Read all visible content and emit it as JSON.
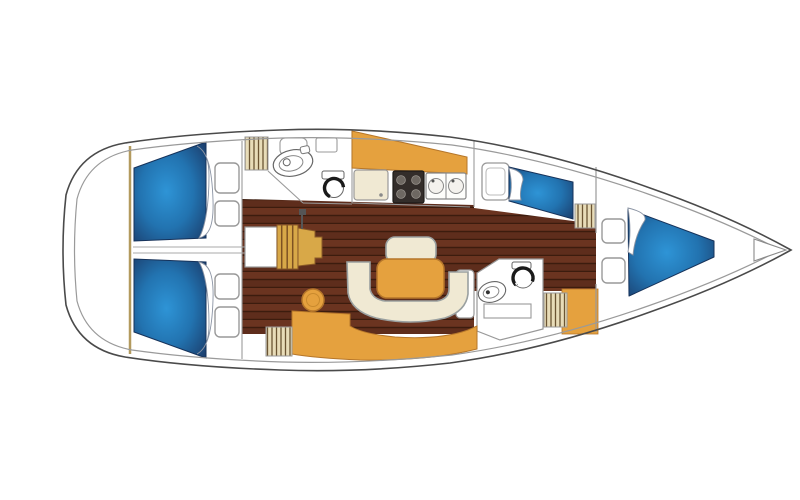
{
  "plan": {
    "diagram_type": "sailboat-interior-floorplan",
    "bow_direction": "right",
    "stern_direction": "left",
    "rooms": [
      "aft-cabin-port",
      "aft-cabin-starboard",
      "aft-head",
      "companionway",
      "saloon",
      "galley",
      "forward-cabin-port",
      "forward-head",
      "bow-cabin"
    ],
    "fixtures": [
      "double-berth",
      "v-berth",
      "pillow",
      "storage-locker",
      "hanging-locker",
      "washbasin",
      "toilet",
      "galley-sink",
      "stove",
      "double-sink",
      "icebox",
      "saloon-table",
      "u-settee",
      "settee-seat",
      "stool",
      "companionway-steps",
      "chart-table",
      "mast-post",
      "anchor-locker"
    ]
  },
  "colors": {
    "white": "#ffffff",
    "hull_outline": "#4a4a4a",
    "deck_line": "#9a9a9a",
    "furniture_outline": "#8f9494",
    "berth_center": "#2e94d6",
    "berth_mid": "#2273b0",
    "berth_edge": "#1a3a68",
    "floor_brown": "#5e2d1c",
    "floor_plank_light": "#6b3420",
    "floor_plank_line": "#3c1c0e",
    "wood_orange": "#e5a13e",
    "wood_orange_outline": "#b5762a",
    "cream": "#f0e9d3",
    "louver_bg": "#e8dcb8",
    "louver_line": "#6b5432",
    "steps_wood": "#d8a848",
    "steps_line": "#7d5122",
    "stove_dark": "#332d2a",
    "bulkhead_tan": "#b39a5e"
  }
}
